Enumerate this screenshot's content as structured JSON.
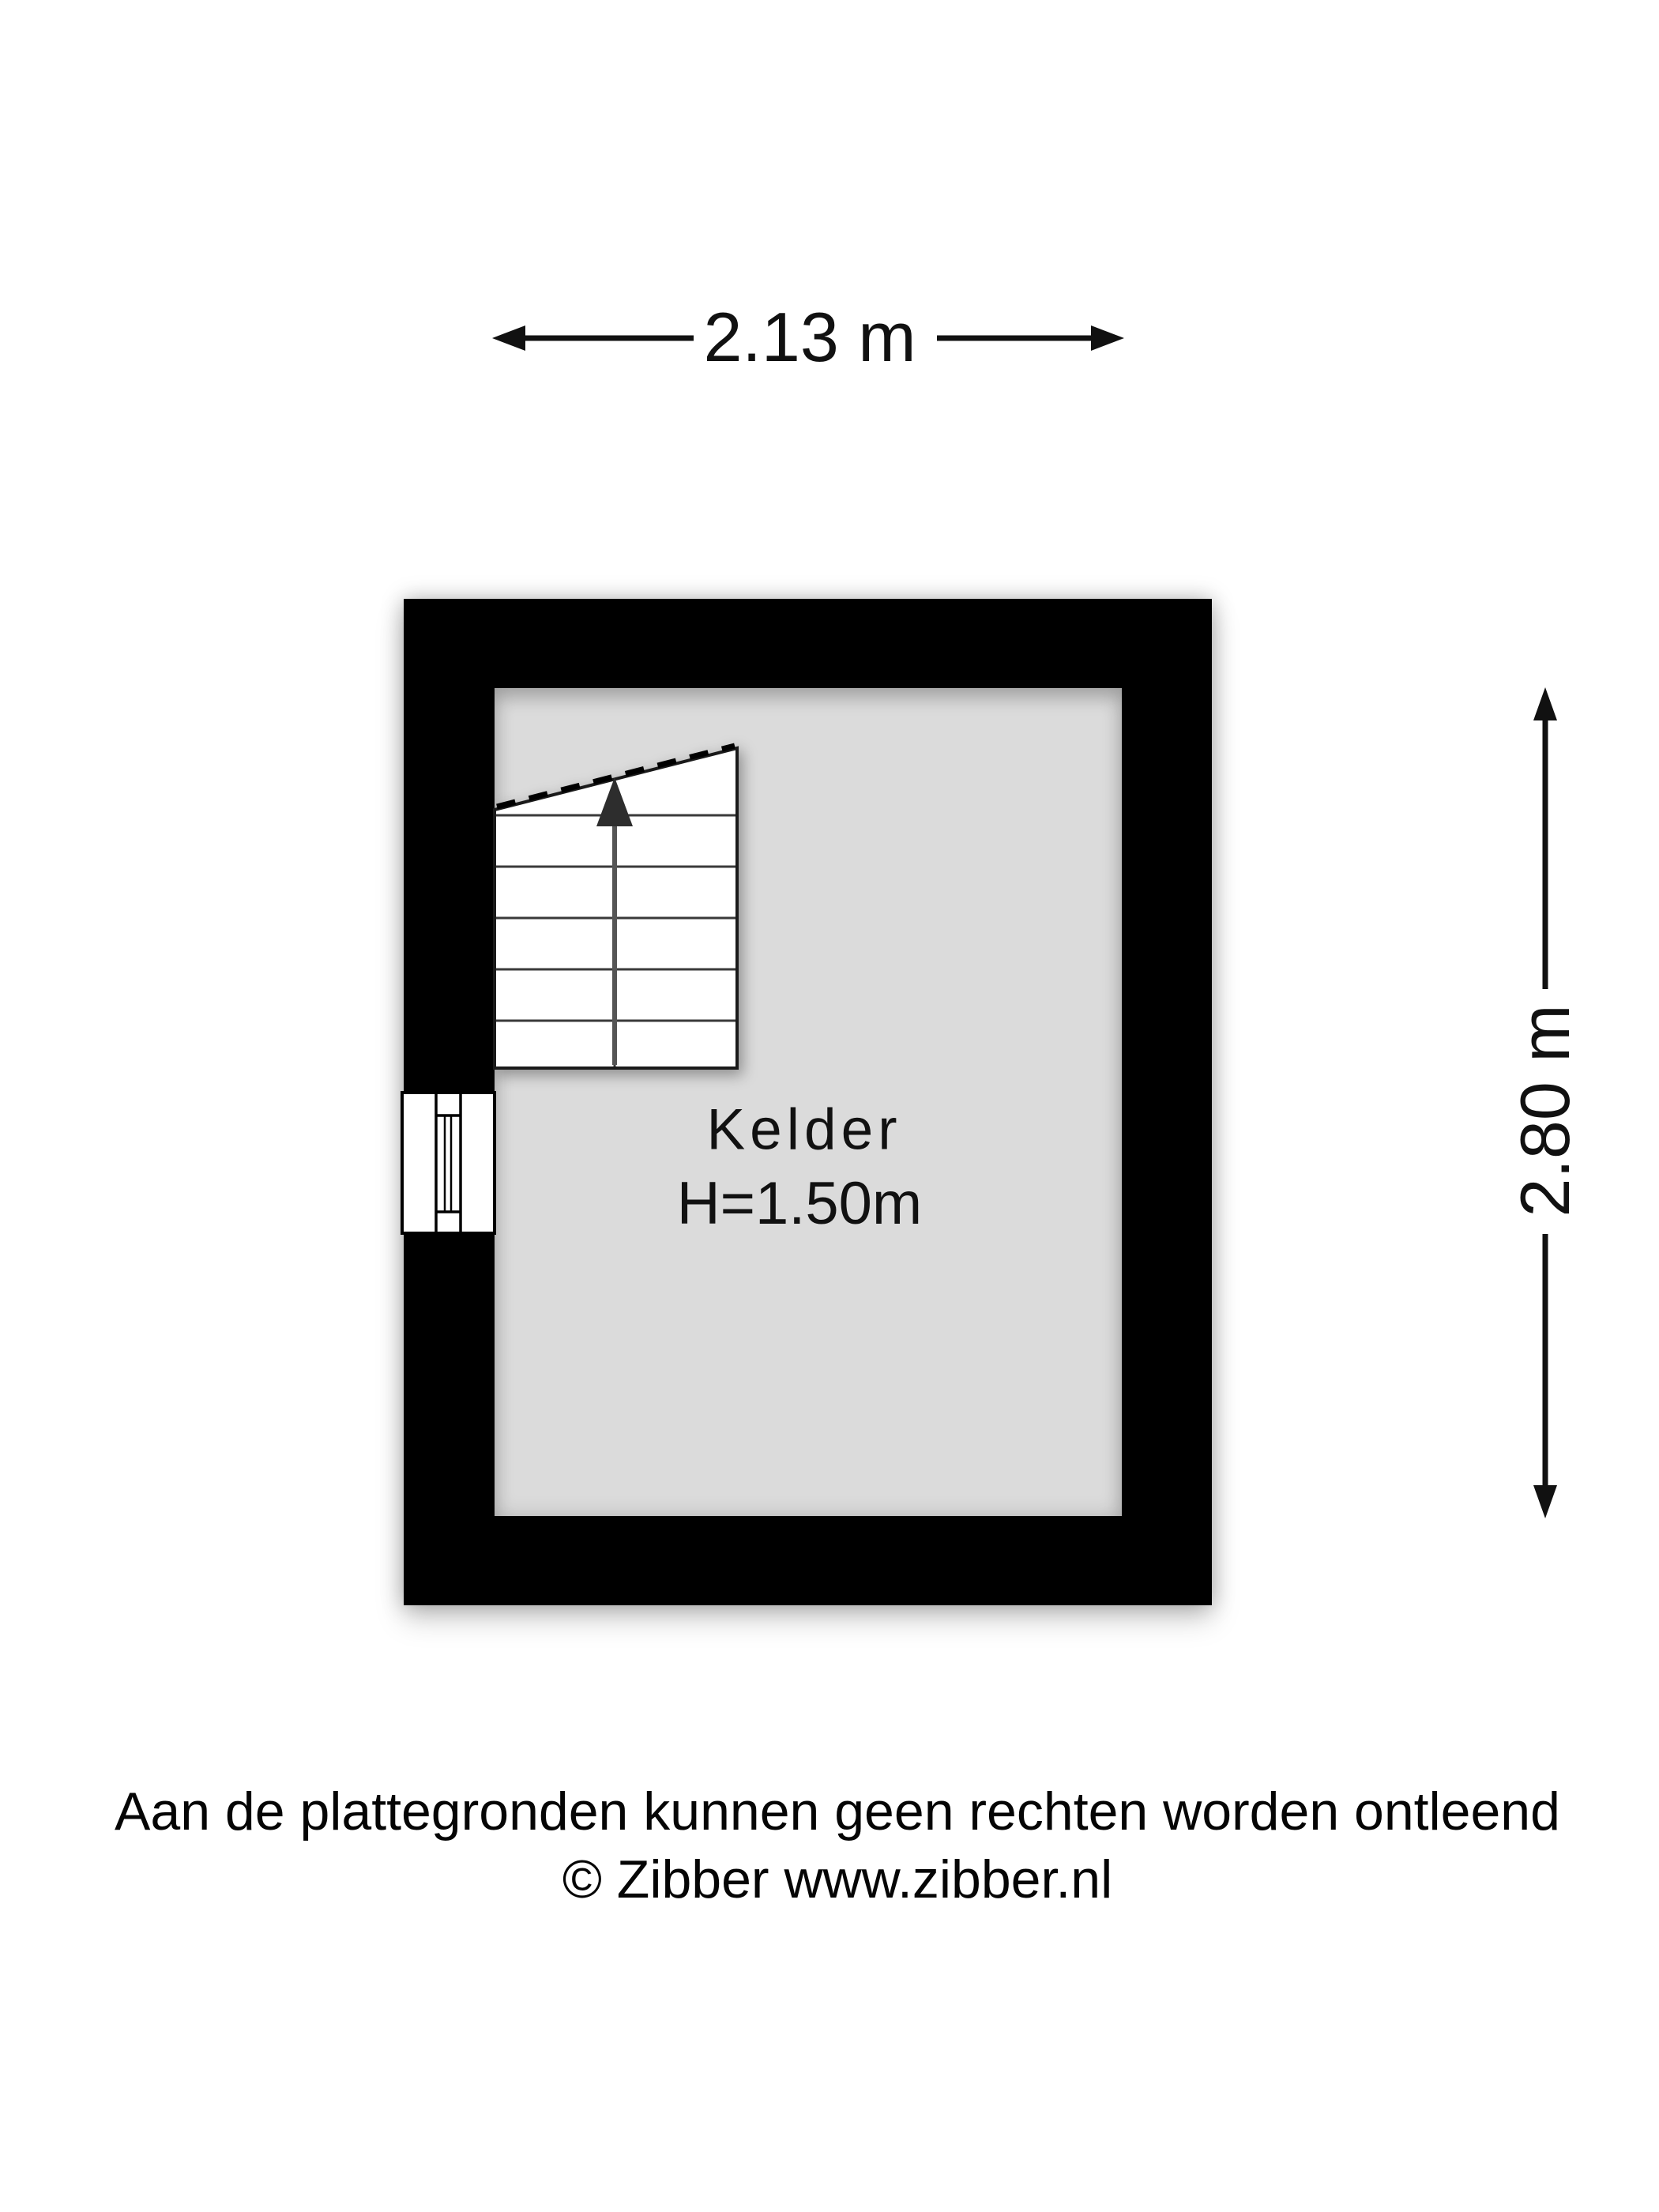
{
  "dimensions": {
    "width_label": "2.13 m",
    "height_label": "2.80 m"
  },
  "room": {
    "name": "Kelder",
    "ceiling_height": "H=1.50m"
  },
  "footer": {
    "disclaimer": "Aan de plattegronden kunnen geen rechten worden ontleend",
    "copyright": "© Zibber www.zibber.nl"
  },
  "colors": {
    "wall": "#000000",
    "floor": "#dbdbdb",
    "background": "#ffffff",
    "ink": "#111111"
  }
}
